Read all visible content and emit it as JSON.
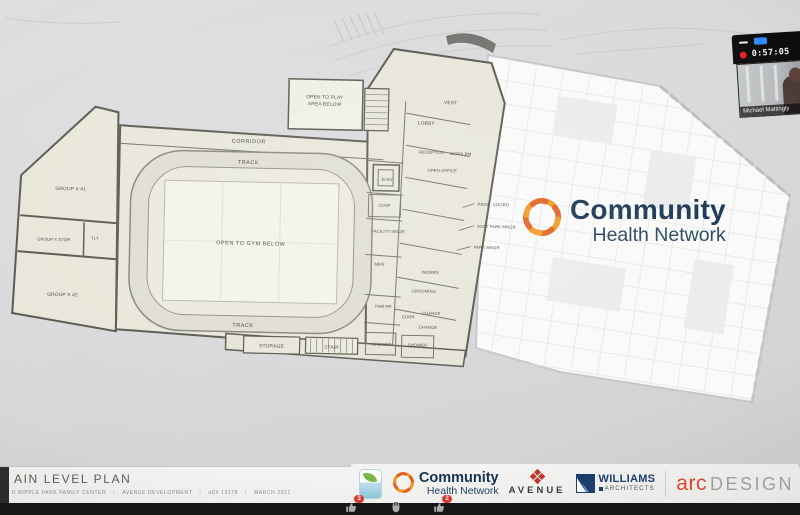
{
  "meeting": {
    "recording": {
      "time": "0:57:05"
    },
    "participant": {
      "name": "Michael Mattingly"
    },
    "reactions": [
      {
        "name": "thumbs-up",
        "badge": "3"
      },
      {
        "name": "raised-hand",
        "badge": ""
      },
      {
        "name": "thumbs-up",
        "badge": "2"
      }
    ]
  },
  "watermark": {
    "line1": "Community",
    "line2": "Health Network"
  },
  "plan": {
    "rooms": {
      "corridor": "CORRIDOR",
      "track_top": "TRACK",
      "track_bottom": "TRACK",
      "open_gym": "OPEN TO GYM BELOW",
      "open_play_l1": "OPEN TO PLAY",
      "open_play_l2": "AREA BELOW",
      "group_x1": "GROUP X #1",
      "group_x_stor": "GROUP X STOR",
      "tlt": "TLT",
      "group_x2": "GROUP X #2",
      "storage": "STORAGE",
      "stair": "STAIR",
      "vest": "VEST",
      "lobby": "LOBBY",
      "reception": "RECEPTION",
      "work_rm": "WORK RM",
      "open_office": "OPEN OFFICE",
      "elev": "ELEV",
      "conf": "CONF",
      "facility_mngr": "FACILITY MNGR",
      "prog_coord": "PROG. COORD",
      "asst_park_mngr": "ASST PARK MNGR",
      "park_mngr": "PARK MNGR",
      "men": "MEN",
      "women": "WOMEN",
      "grooming": "GROOMING",
      "fam_rr": "FAM RR",
      "corr": "CORR",
      "change1": "CHANGE",
      "change2": "CHANGE",
      "shower1": "SHOWER",
      "shower2": "SHOWER"
    }
  },
  "titleblock": {
    "title": "AIN LEVEL PLAN",
    "project": "D RIPPLE PARK FAMILY CENTER",
    "developer": "AVENUE DEVELOPMENT",
    "job": "aD# 19178",
    "date": "MARCH 2021",
    "sep": "|"
  },
  "footer": {
    "community_line1": "Community",
    "community_line2": "Health Network",
    "avenue": "AVENUE",
    "williams_line1": "WILLIAMS",
    "williams_line2": "ARCHITECTS",
    "arc_red": "arc",
    "arc_gray": "DESIGN"
  },
  "colors": {
    "navy": "#16324f",
    "orange": "#ee7d23",
    "record_red": "#e02020",
    "notification_red": "#e0392f",
    "button_blue": "#2d8cff"
  }
}
